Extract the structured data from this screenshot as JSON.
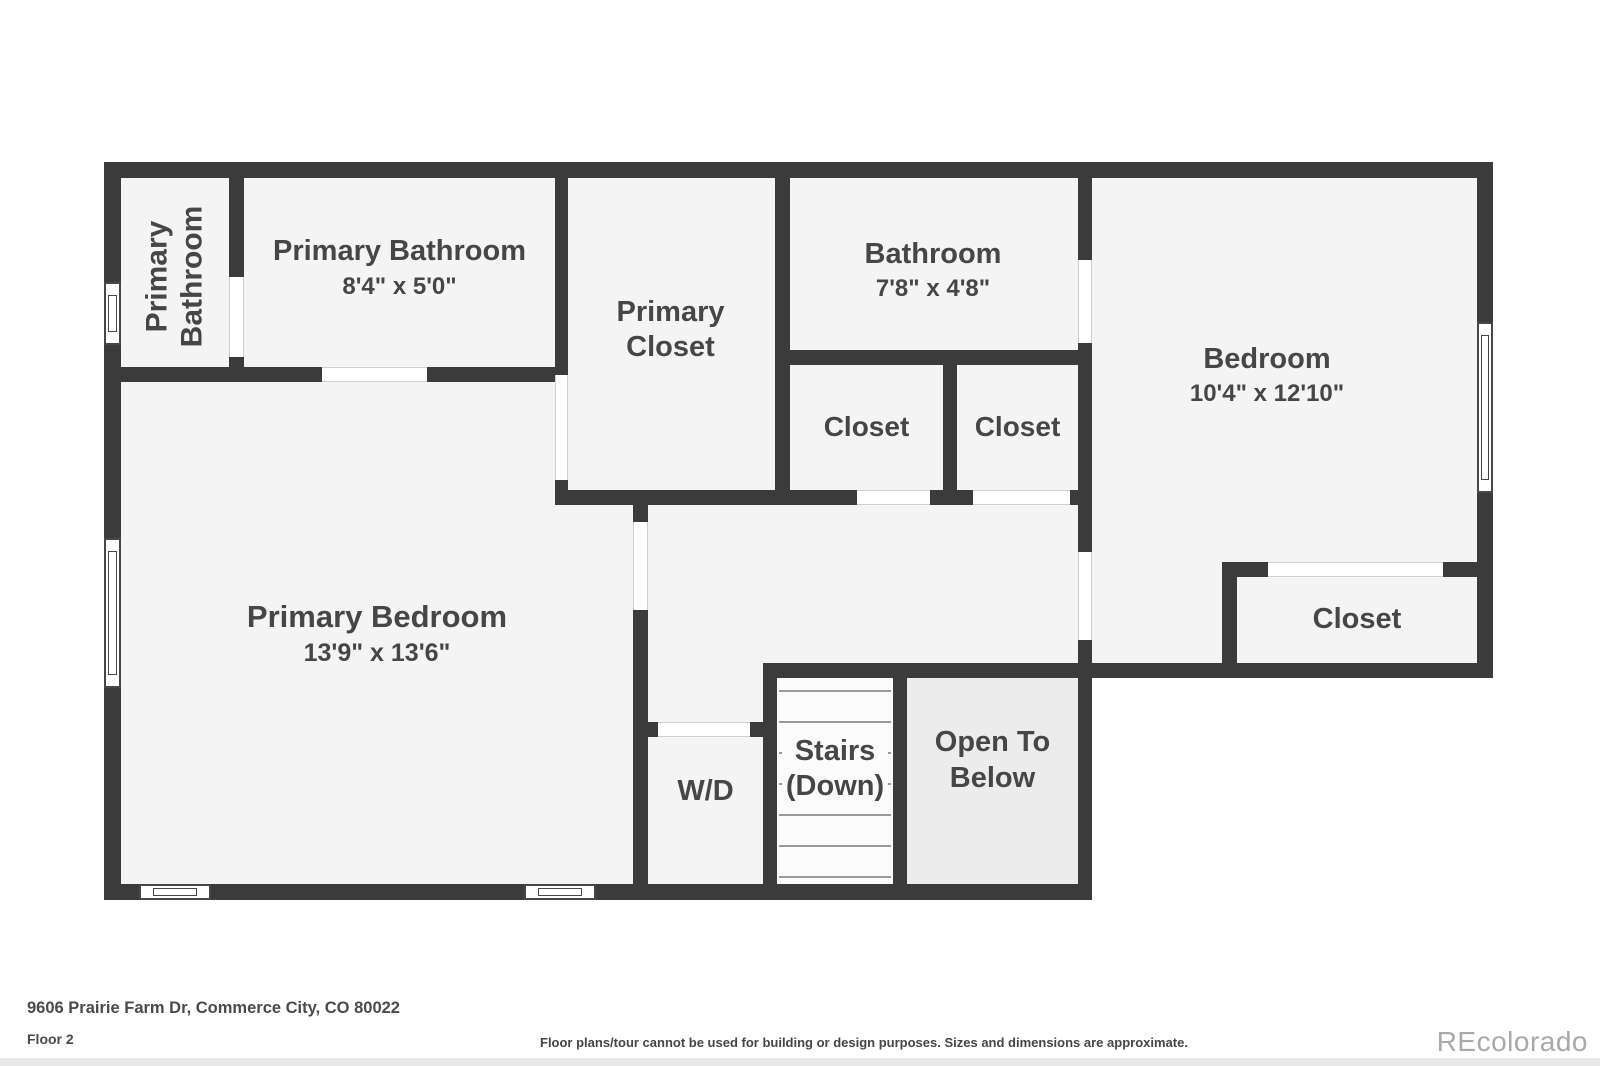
{
  "plan": {
    "wall_color": "#3b3b3b",
    "room_fill_color": "#f4f4f4",
    "stairs_fill_color": "#fbfbfb",
    "open_to_below_fill_color": "#ececec",
    "rooms": {
      "primary_bathroom_wc": {
        "name": "Primary\nBathroom"
      },
      "primary_bathroom": {
        "name": "Primary Bathroom",
        "dims": "8'4\" x 5'0\""
      },
      "primary_closet": {
        "name": "Primary\nCloset"
      },
      "bathroom": {
        "name": "Bathroom",
        "dims": "7'8\" x 4'8\""
      },
      "hall_closet_1": {
        "name": "Closet"
      },
      "hall_closet_2": {
        "name": "Closet"
      },
      "bedroom": {
        "name": "Bedroom",
        "dims": "10'4\" x 12'10\""
      },
      "bedroom_closet": {
        "name": "Closet"
      },
      "primary_bedroom": {
        "name": "Primary Bedroom",
        "dims": "13'9\" x 13'6\""
      },
      "laundry": {
        "name": "W/D"
      },
      "stairs": {
        "name": "Stairs\n(Down)"
      },
      "open_to_below": {
        "name": "Open To\nBelow"
      }
    }
  },
  "footer": {
    "address": "9606 Prairie Farm Dr, Commerce City, CO 80022",
    "floor_label": "Floor 2",
    "disclaimer": "Floor plans/tour cannot be used for building or design purposes. Sizes and dimensions are approximate.",
    "brand": "REcolorado"
  }
}
